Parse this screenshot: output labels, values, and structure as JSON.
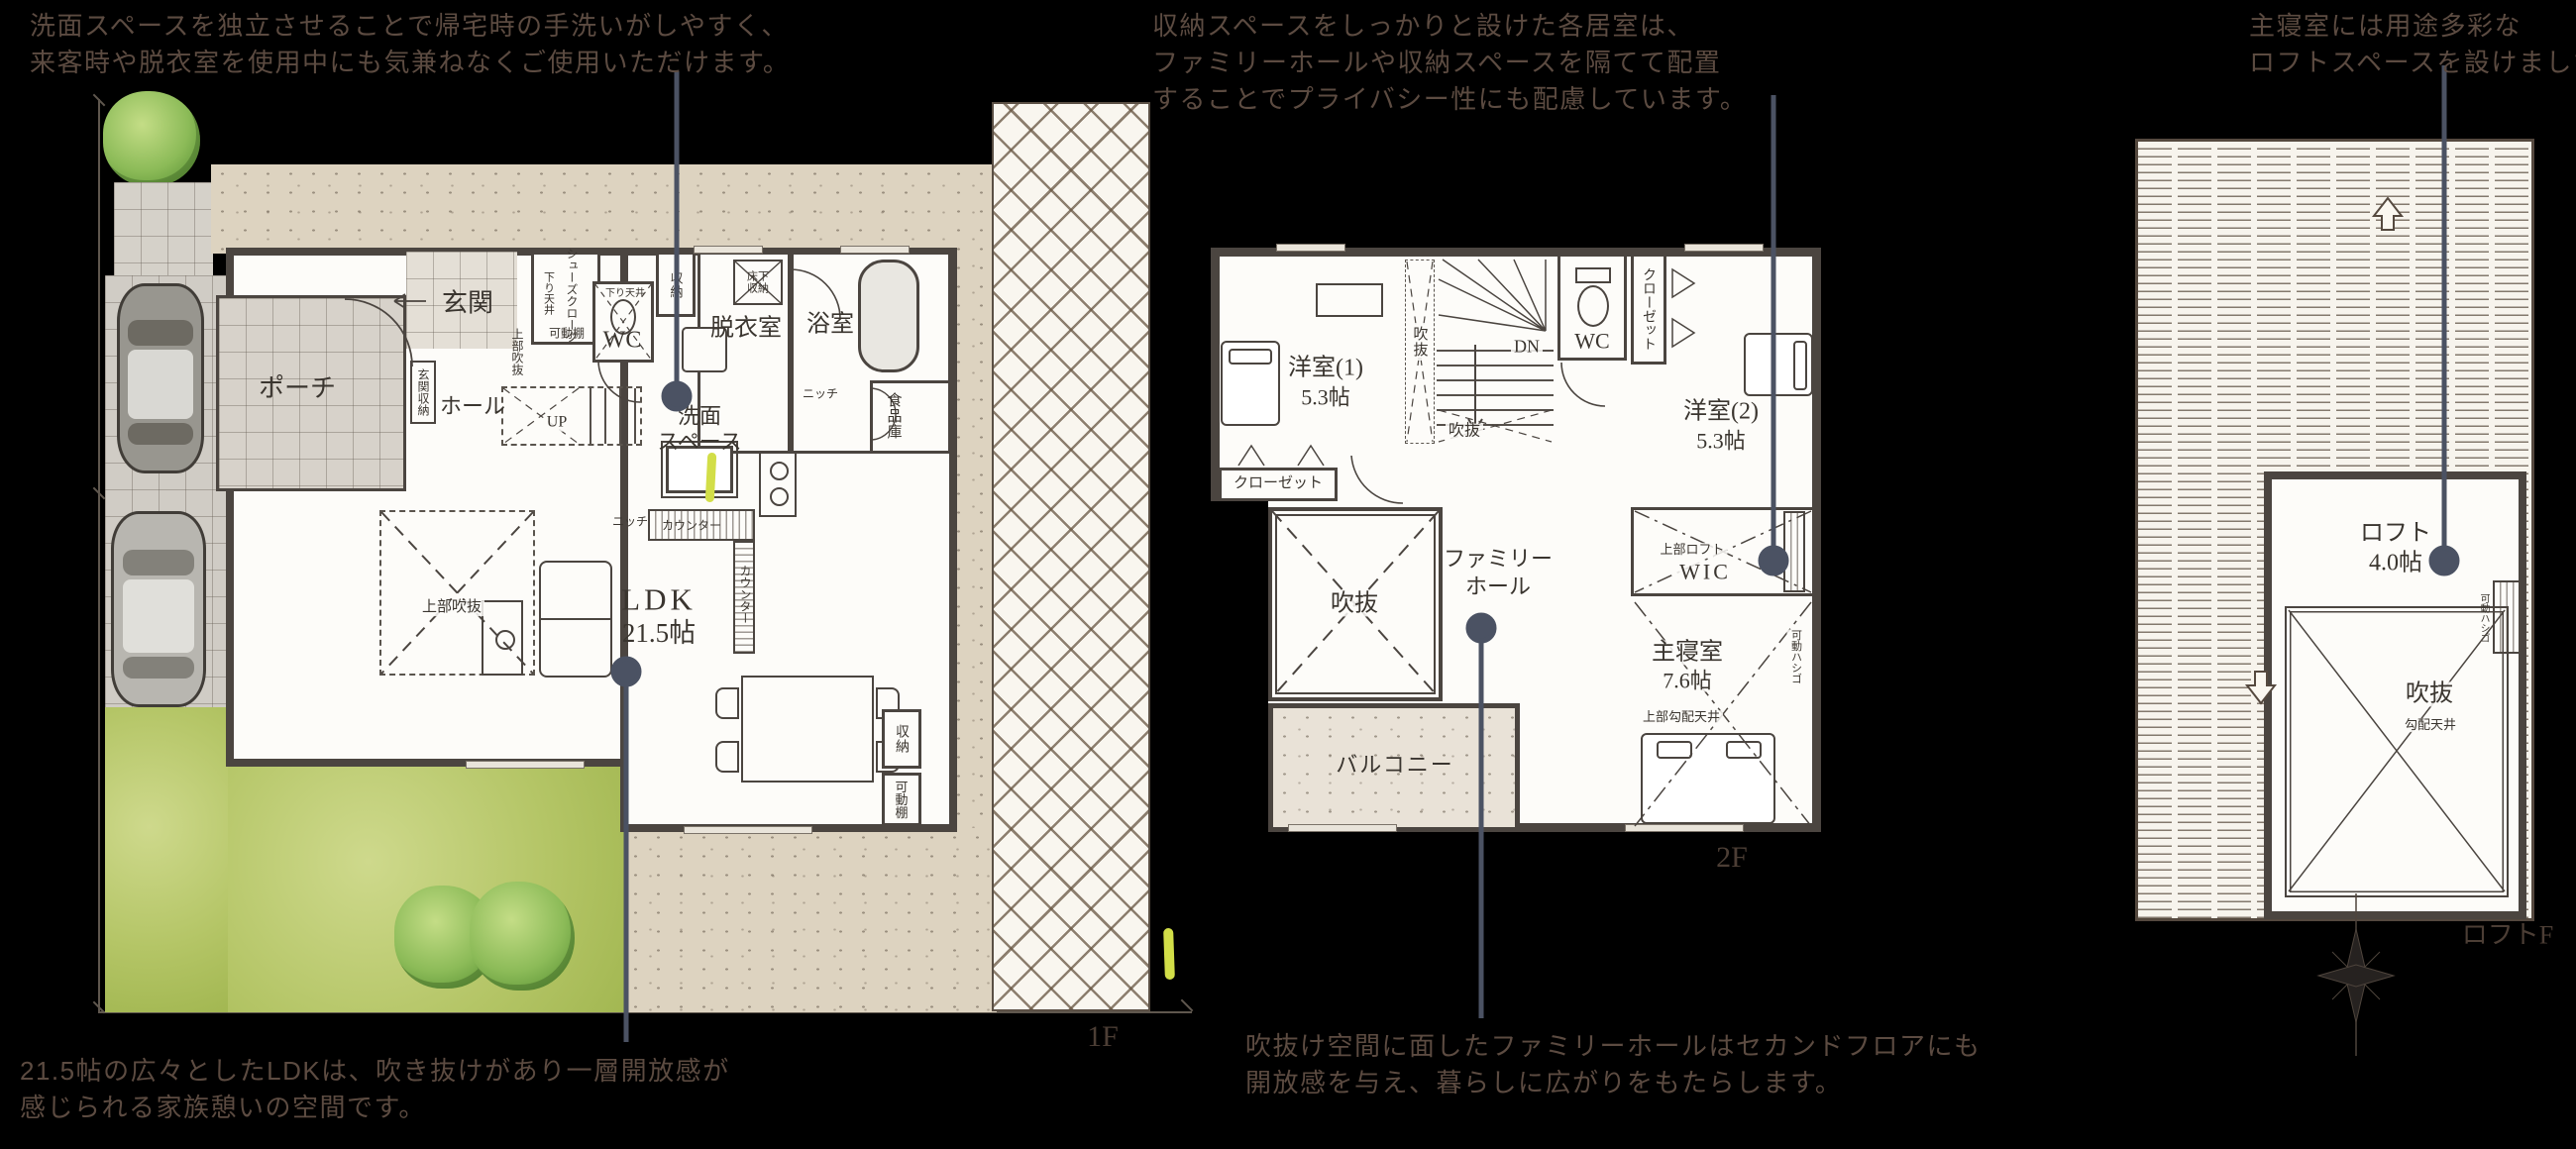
{
  "annotations": {
    "washroom_note": {
      "lines": [
        "洗面スペースを独立させることで帰宅時の手洗いがしやすく、",
        "来客時や脱衣室を使用中にも気兼ねなくご使用いただけます。"
      ]
    },
    "privacy_note": {
      "lines": [
        "収納スペースをしっかりと設けた各居室は、",
        "ファミリーホールや収納スペースを隔てて配置",
        "することでプライバシー性にも配慮しています。"
      ]
    },
    "loft_note": {
      "lines": [
        "主寝室には用途多彩な",
        "ロフトスペースを設けました。"
      ]
    },
    "ldk_note": {
      "lines": [
        "21.5帖の広々としたLDKは、吹き抜けがあり一層開放感が",
        "感じられる家族憩いの空間です。"
      ]
    },
    "family_hall_note": {
      "lines": [
        "吹抜け空間に面したファミリーホールはセカンドフロアにも",
        "開放感を与え、暮らしに広がりをもたらします。"
      ]
    }
  },
  "floor_1f": {
    "tag": "1F",
    "labels": {
      "porch": "ポーチ",
      "entrance": "玄関",
      "shoes_closet": "シューズクローク",
      "shoes_ceiling": "下り天井",
      "shoes_shelf": "可動棚",
      "stair_void": "上部吹抜",
      "entrance_storage": "玄関収納",
      "hall": "ホール",
      "up": "UP",
      "wc": "WC",
      "wc_ceiling": "下り天井",
      "laundry_storage": "収納",
      "dressing_room": "脱衣室",
      "floor_storage": "床下収納",
      "bathroom": "浴室",
      "niche_a": "ニッチ",
      "pantry": "食品庫",
      "wash_space_1": "洗面",
      "wash_space_2": "スペース",
      "counter_a": "カウンター",
      "counter_b": "カウンター",
      "niche_b": "ニッチ",
      "living_void": "上部吹抜",
      "ldk": "LDK",
      "ldk_size": "21.5帖",
      "storage": "収納",
      "shelf": "可動棚"
    }
  },
  "floor_2f": {
    "tag": "2F",
    "labels": {
      "bedroom1": "洋室(1)",
      "bedroom1_size": "5.3帖",
      "side_void": "吹抜",
      "dn": "DN",
      "stair_void": "吹抜",
      "wc": "WC",
      "closet_a": "クローゼット",
      "bedroom2": "洋室(2)",
      "bedroom2_size": "5.3帖",
      "closet_b": "クローゼット",
      "main_void": "吹抜",
      "family_hall_1": "ファミリー",
      "family_hall_2": "ホール",
      "upper_loft": "上部ロフト",
      "wic": "WIC",
      "master": "主寝室",
      "master_size": "7.6帖",
      "sloped_ceiling": "上部勾配天井",
      "ladder": "可動ハシゴ",
      "balcony": "バルコニー"
    }
  },
  "floor_loft": {
    "tag": "ロフトF",
    "labels": {
      "loft": "ロフト",
      "loft_size": "4.0帖",
      "void": "吹抜",
      "sloped_ceiling": "勾配天井",
      "ladder": "可動ハシゴ"
    }
  }
}
